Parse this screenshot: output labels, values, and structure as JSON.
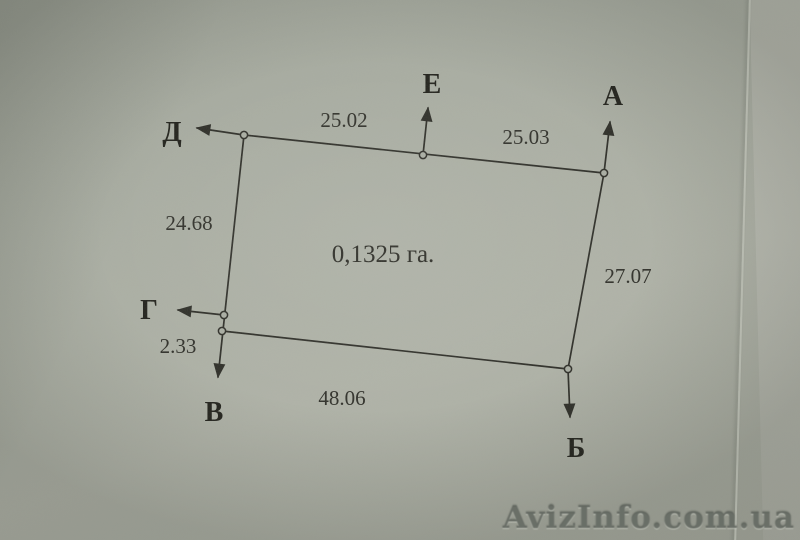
{
  "photo": {
    "watermark_text": "AvizInfo.com.ua",
    "paper_color": "#a9ada2",
    "under_page_color": "#b6b8ae",
    "ink_color": "#2e2e28"
  },
  "diagram": {
    "type": "land-plot-survey-sketch",
    "area_label": "0,1325 га.",
    "area_ha": "0,1325",
    "points": {
      "a": {
        "label": "А"
      },
      "b": {
        "label": "Б"
      },
      "v": {
        "label": "В"
      },
      "g": {
        "label": "Г"
      },
      "d": {
        "label": "Д"
      },
      "e": {
        "label": "Е"
      }
    },
    "measurements": {
      "d_e": "25.02",
      "e_a": "25.03",
      "d_g": "24.68",
      "g_v": "2.33",
      "v_b": "48.06",
      "a_b": "27.07"
    },
    "sides": [
      {
        "from": "Д",
        "to": "Е",
        "length": "25.02"
      },
      {
        "from": "Е",
        "to": "А",
        "length": "25.03"
      },
      {
        "from": "Д",
        "to": "Г",
        "length": "24.68"
      },
      {
        "from": "Г",
        "to": "В",
        "length": "2.33"
      },
      {
        "from": "В",
        "to": "Б",
        "length": "48.06"
      },
      {
        "from": "А",
        "to": "Б",
        "length": "27.07"
      }
    ]
  }
}
